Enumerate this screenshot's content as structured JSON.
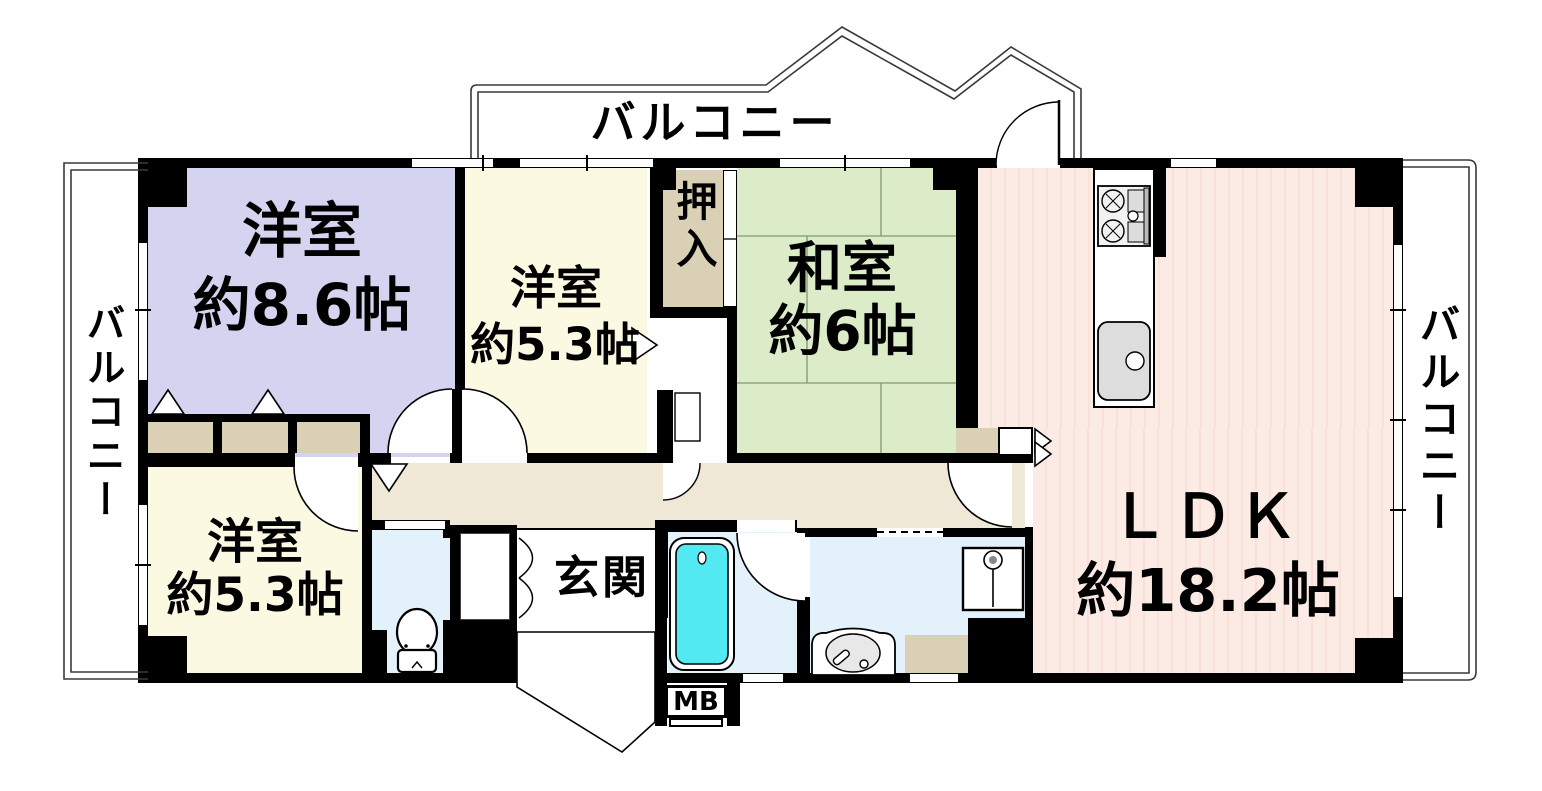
{
  "plan_title": "マンション間取り図",
  "rooms": {
    "western1": {
      "name": "洋室",
      "size": "約8.6帖"
    },
    "western2": {
      "name": "洋室",
      "size": "約5.3帖"
    },
    "japanese": {
      "name": "和室",
      "size": "約6帖"
    },
    "ldk": {
      "name": "ＬＤＫ",
      "size": "約18.2帖"
    },
    "western3": {
      "name": "洋室",
      "size": "約5.3帖"
    },
    "oshiire": {
      "name": "押入"
    },
    "genkan": {
      "name": "玄関"
    },
    "meter_box": {
      "name": "MB"
    }
  },
  "balconies": {
    "top": "バルコニー",
    "left": "バルコニー",
    "right": "バルコニー"
  },
  "colors": {
    "wall": "#000000",
    "western": "#d5d4f0",
    "japanese": "#dcecc9",
    "cream": "#fcf9e3",
    "ldk": "#fcebe4",
    "ldk_stripe": "#f7e1d9",
    "tan": "#d9d0b6",
    "hall": "#efe8d6",
    "wet": "#e3f1fb",
    "tub": "#52e9f2",
    "balcony_line": "#3a3a3a",
    "tatami_line": "#7e9a6e"
  }
}
